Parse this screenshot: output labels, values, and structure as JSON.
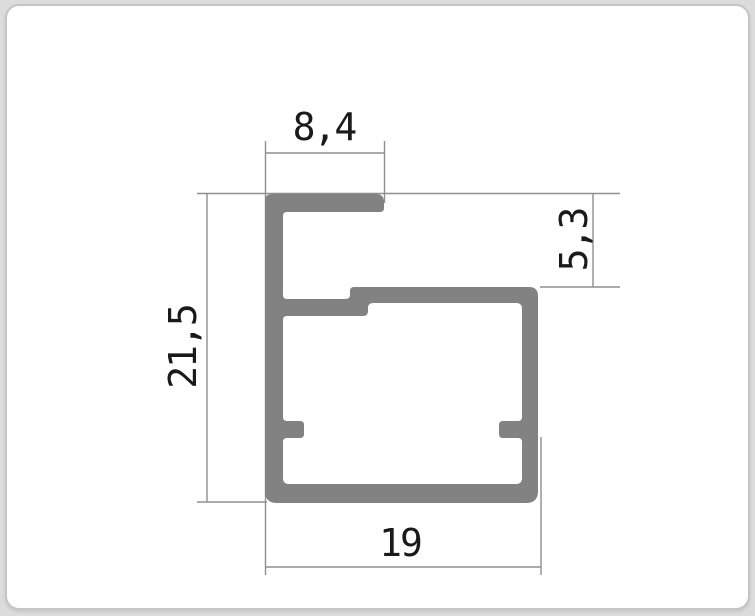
{
  "drawing": {
    "title": "aluminium-profile-cross-section",
    "unit": "mm",
    "dimensions": {
      "top_width": {
        "label": "8,4",
        "mm": 8.4,
        "placement": "top horizontal, above the upper hook bar"
      },
      "slot_height": {
        "label": "5,3",
        "mm": 5.3,
        "placement": "right vertical, rotated 90deg, between profile top and box top"
      },
      "overall_height": {
        "label": "21,5",
        "mm": 21.5,
        "placement": "left vertical, rotated 90deg, full profile height"
      },
      "bottom_width": {
        "label": "19",
        "mm": 19,
        "placement": "bottom horizontal, full box width"
      }
    },
    "colors": {
      "profile_fill": "#828282",
      "dimension_line": "#8f8f8f",
      "text": "#1a1a1a",
      "card_background": "#ffffff",
      "card_border": "#c5c5c5",
      "page_background": "#dcdcdc"
    }
  }
}
